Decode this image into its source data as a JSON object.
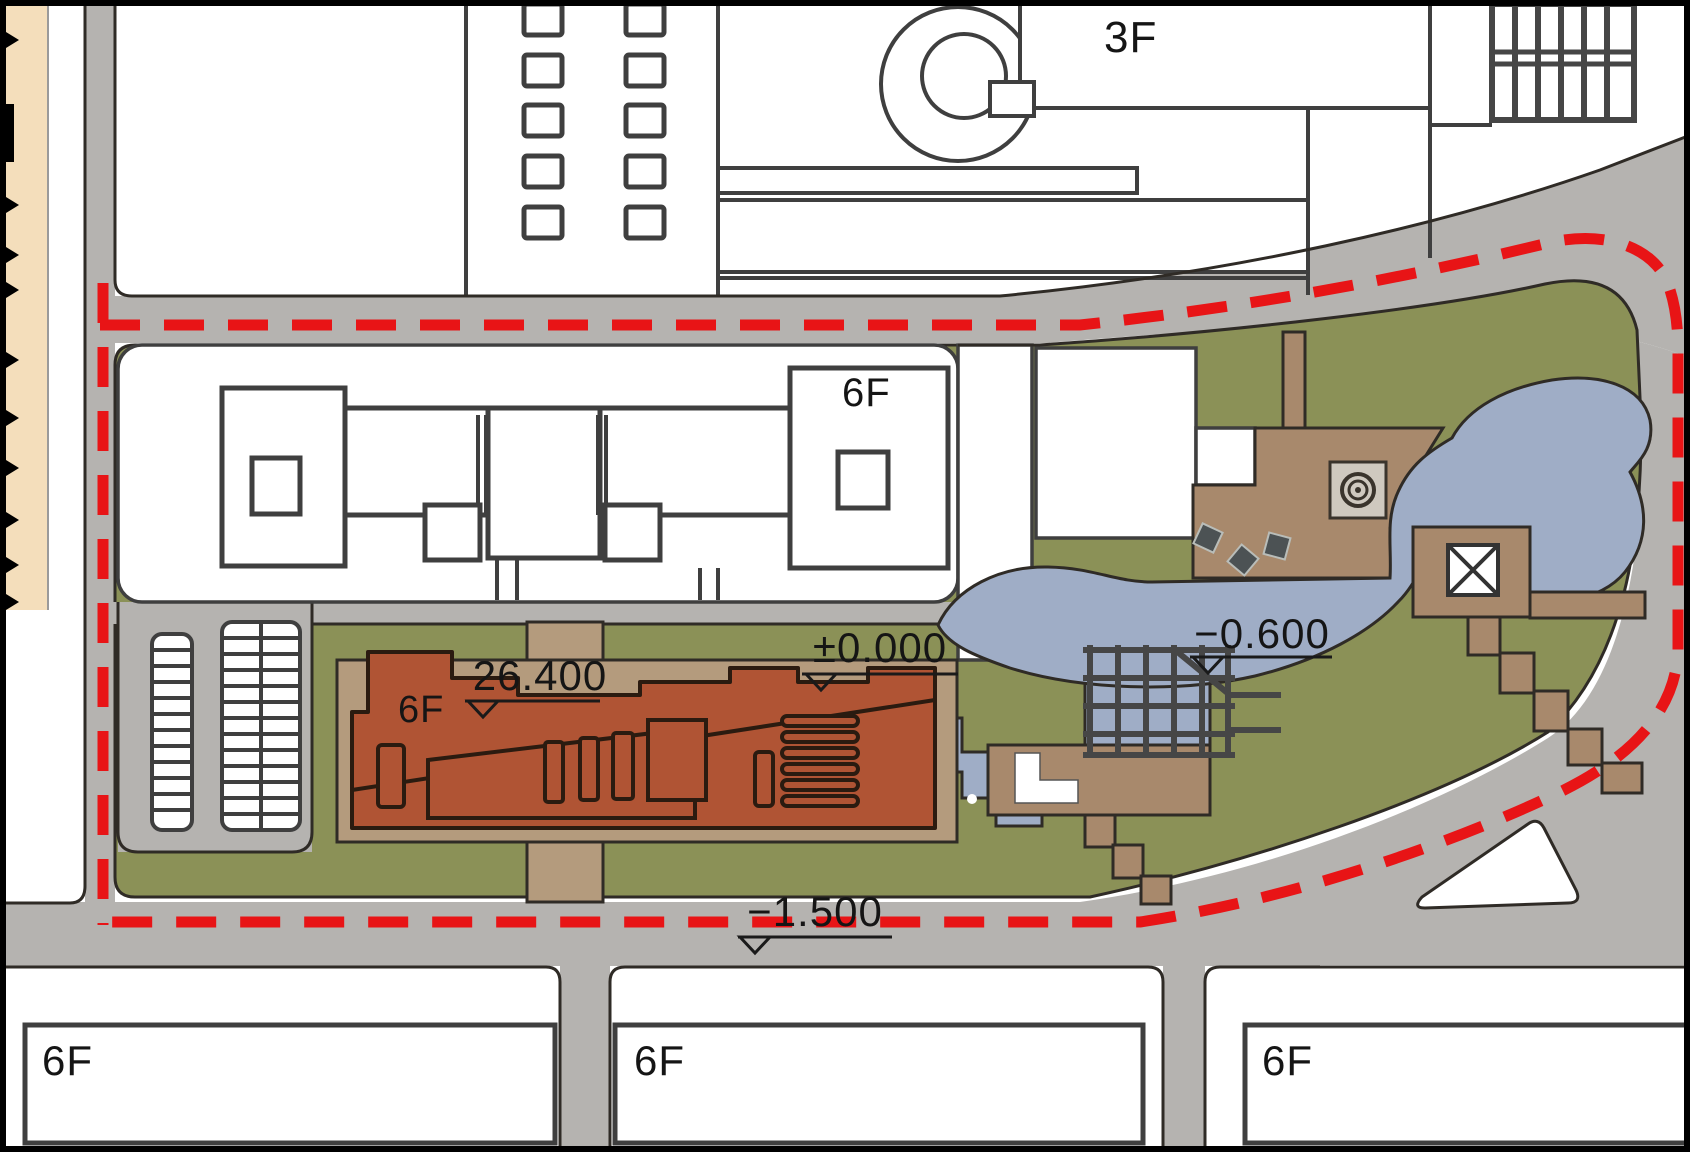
{
  "title": "Architectural site master plan",
  "colors": {
    "road": "#b5b3b0",
    "green": "#8b9157",
    "water": "#9fadc6",
    "plaza": "#b49b7d",
    "plaza2": "#a8896c",
    "building": "#b05434",
    "boundary": "#e81416",
    "linework": "#2f2b26",
    "outline": "#3f3f3f",
    "strip": "#f4debb",
    "label": "#151515"
  },
  "labels": {
    "north_building_floors": "3F",
    "campus_tower_floors": "6F",
    "new_building_floors": "6F",
    "south_building_1_floors": "6F",
    "south_building_2_floors": "6F",
    "south_building_3_floors": "6F"
  },
  "elevations": {
    "roof": "26.400",
    "entrance": "±0.000",
    "pond": "−0.600",
    "road": "−1.500"
  }
}
